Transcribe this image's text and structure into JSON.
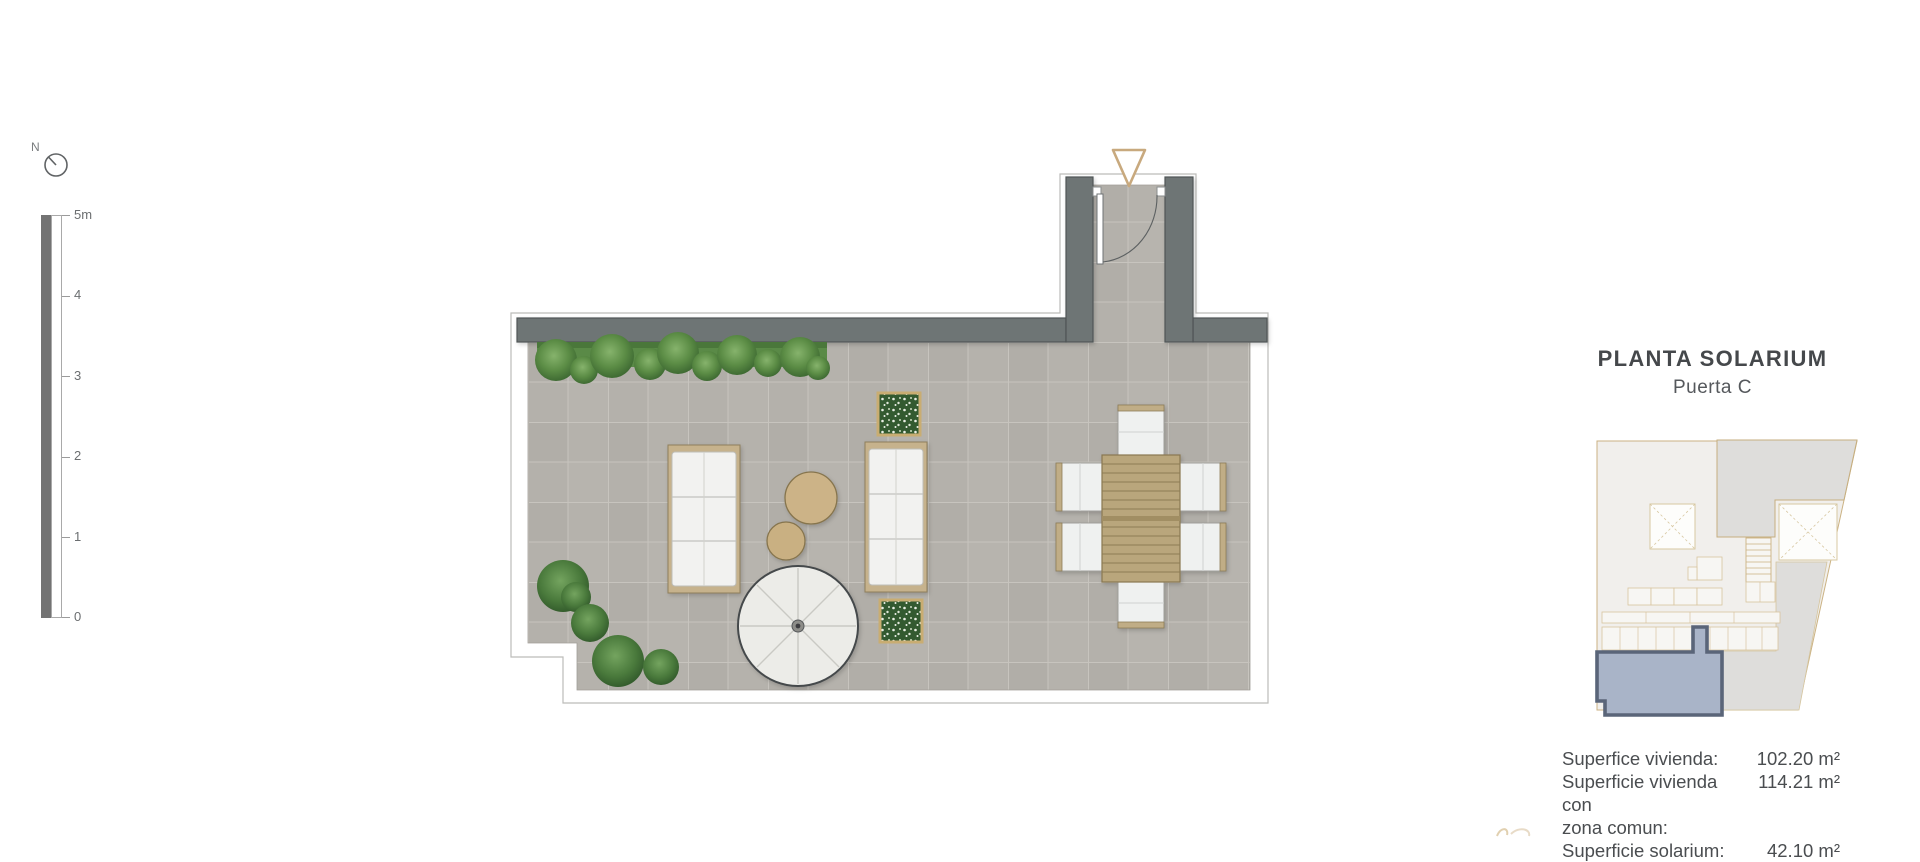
{
  "north_indicator": {
    "label": "N"
  },
  "scale_bar": {
    "labels": [
      "5m",
      "4",
      "3",
      "2",
      "1",
      "0"
    ]
  },
  "title_block": {
    "title": "PLANTA SOLARIUM",
    "subtitle": "Puerta C"
  },
  "area_table": {
    "rows": [
      {
        "label": "Superfice vivienda:",
        "value": "102.20 m²"
      },
      {
        "label": "Superficie vivienda con",
        "value": "114.21 m²"
      },
      {
        "label": "zona comun:",
        "value": ""
      },
      {
        "label": "Superficie solarium:",
        "value": "42.10 m²"
      }
    ]
  },
  "plan": {
    "elements": [
      "perimeter-walls",
      "entrance-door",
      "entrance-arrow",
      "hedge",
      "sun-loungers",
      "side-tables",
      "parasol",
      "planters",
      "dining-set",
      "bushes",
      "tiled-floor"
    ]
  },
  "colors": {
    "wall": "#6e7475",
    "floor": "#b3b0aa",
    "accent-tan": "#c8a97e",
    "hedge-green": "#55853f",
    "unit-fill": "#a9b4c8",
    "unit-stroke": "#5a6579",
    "text-dark": "#45484b",
    "text-medium": "#55585c"
  }
}
